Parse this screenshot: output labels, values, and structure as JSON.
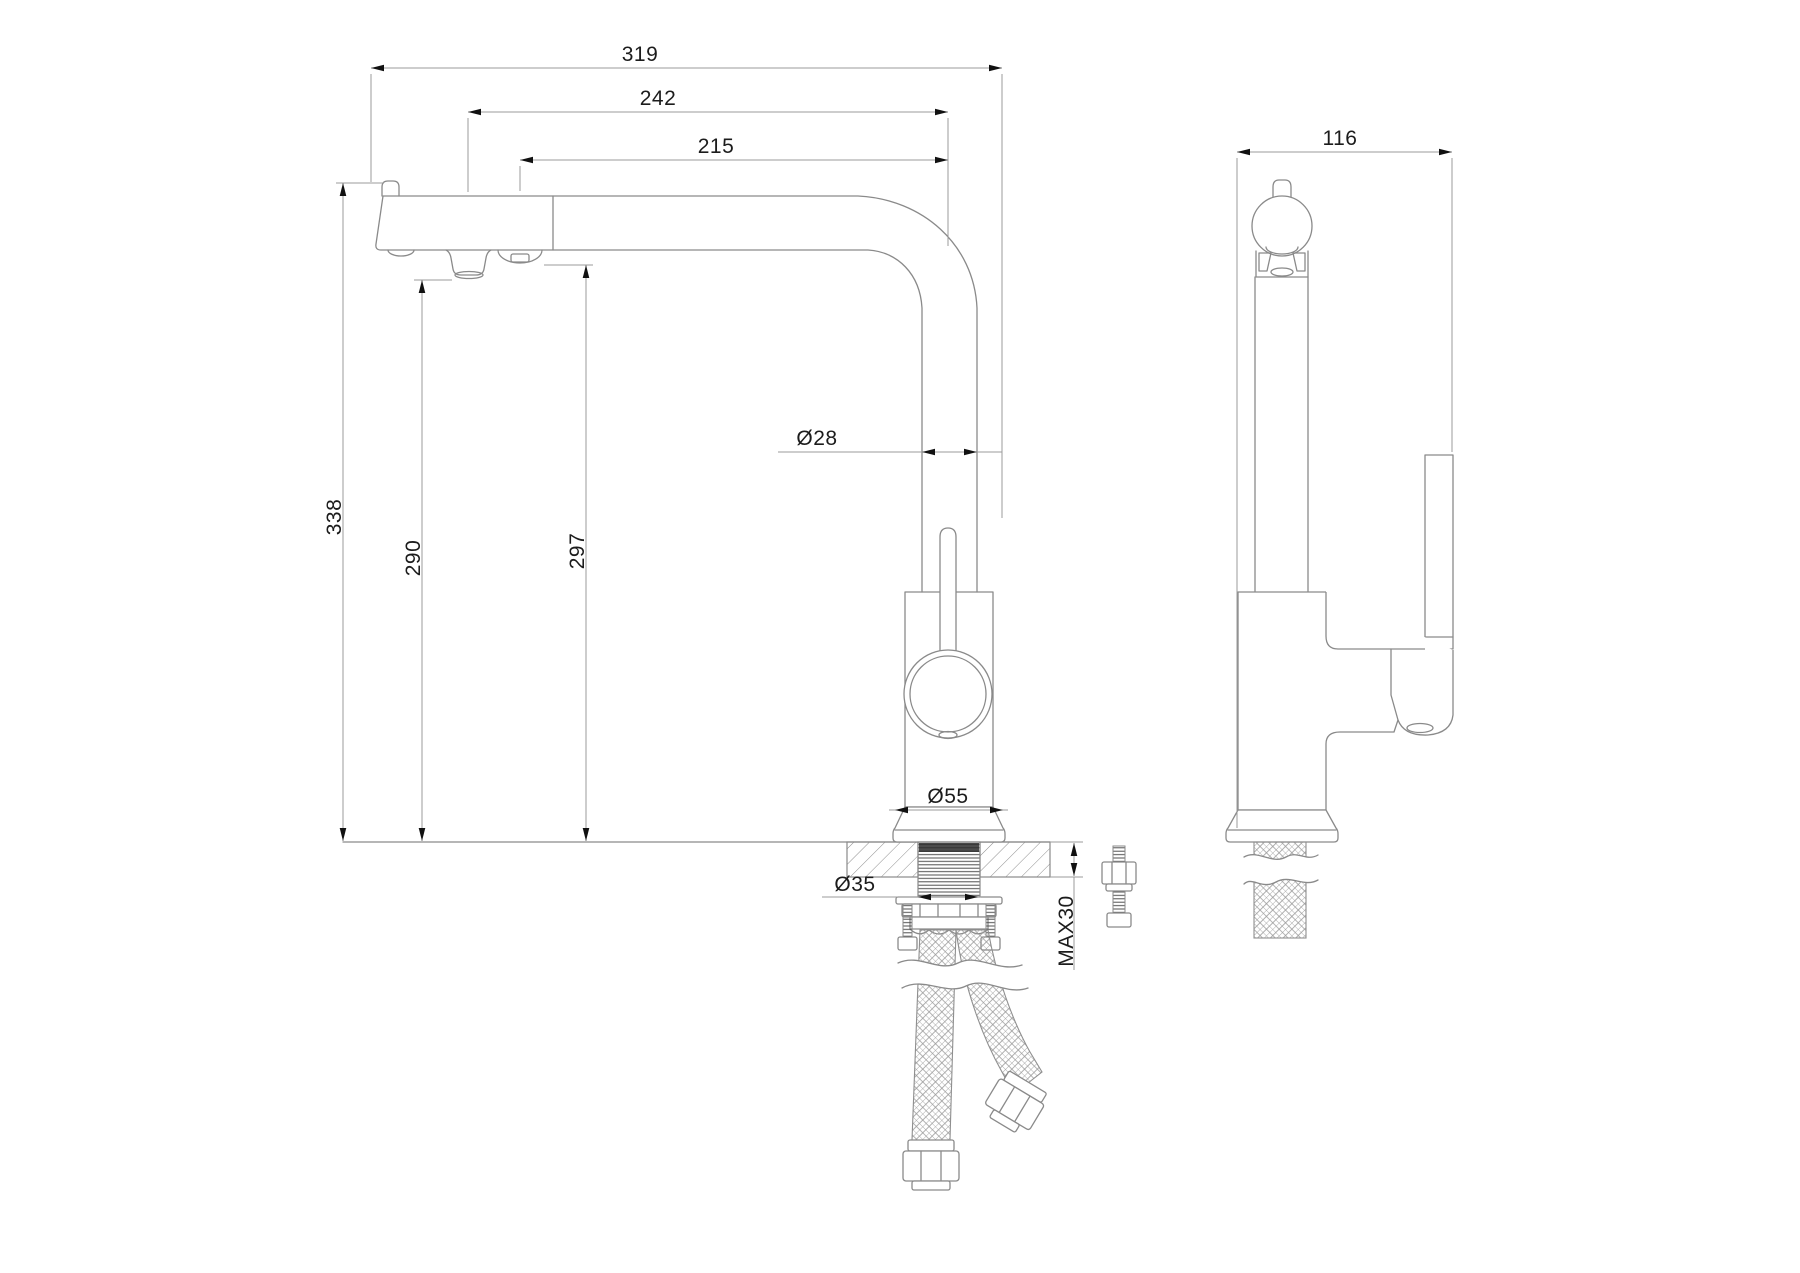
{
  "drawing": {
    "background": "#ffffff",
    "object_line_color": "#8a8a8a",
    "dimension_line_color": "#9b9b9b",
    "arrow_color": "#111111",
    "text_color": "#1c1c1c",
    "front_view": {
      "dimensions": {
        "overall_reach": "319",
        "reach_to_aerator": "242",
        "reach_to_outlet": "215",
        "overall_height": "338",
        "aerator_height": "290",
        "outlet_height": "297",
        "spout_tube_diameter": "Ø28",
        "base_diameter": "Ø55",
        "mount_hole_diameter": "Ø35",
        "max_counter_thickness": "MAX30"
      }
    },
    "side_view": {
      "dimensions": {
        "overall_depth": "116"
      }
    }
  }
}
